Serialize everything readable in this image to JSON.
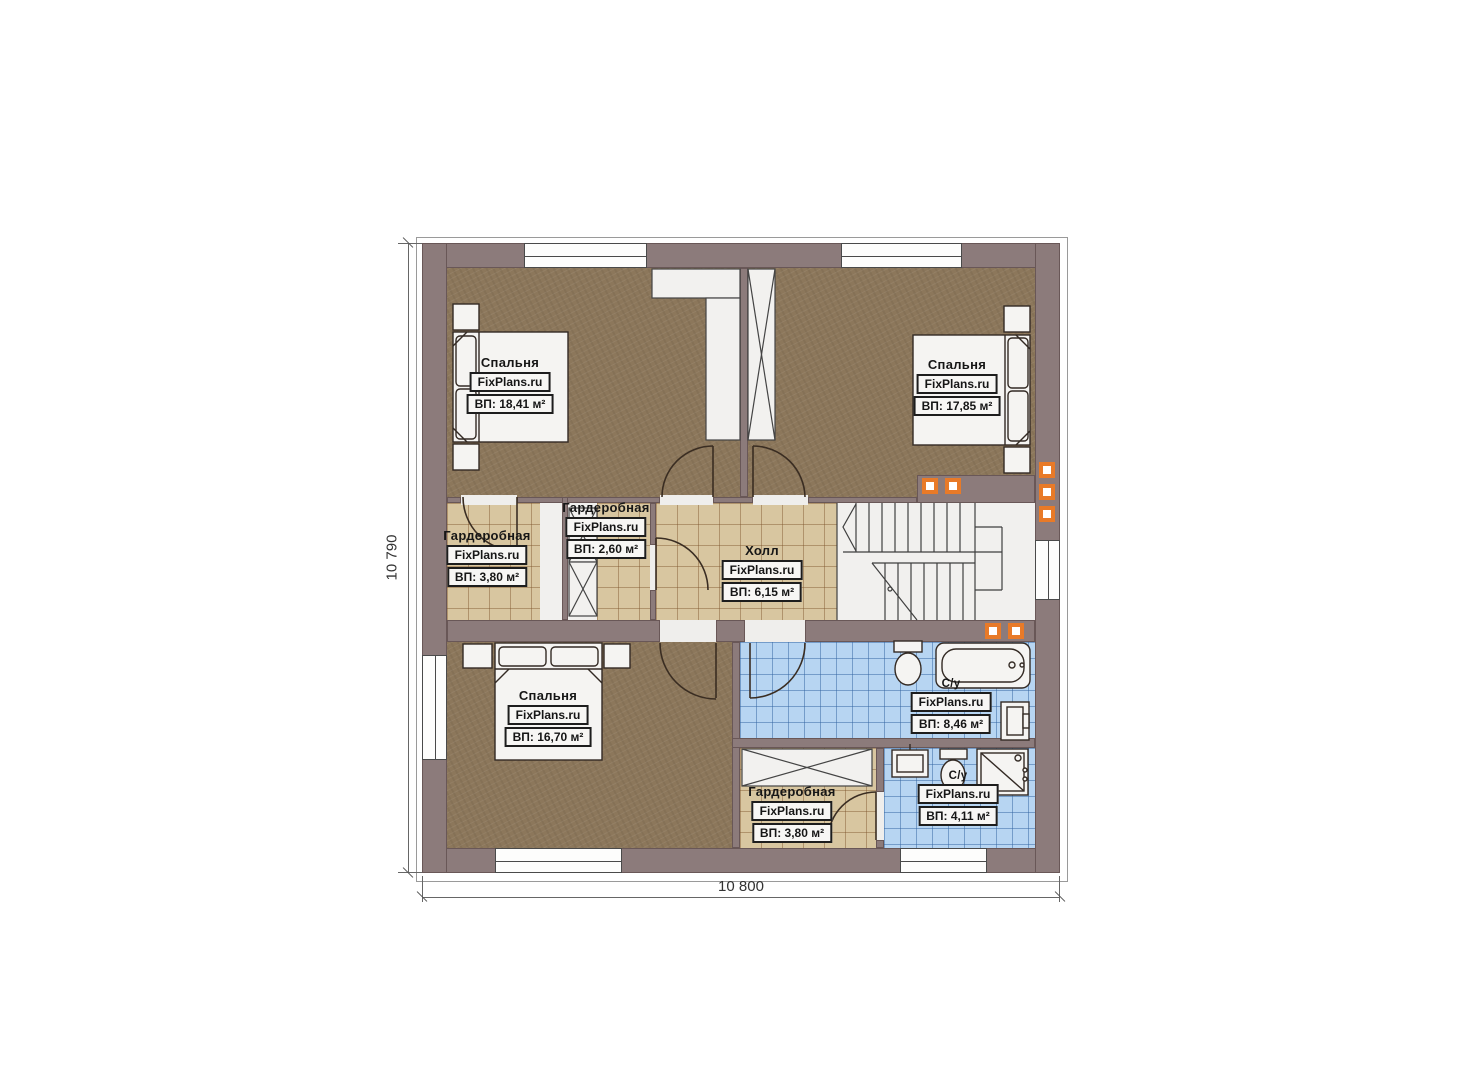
{
  "brand": "FixPlans.ru",
  "dimensions": {
    "width": "10 800",
    "height": "10 790"
  },
  "rooms": [
    {
      "name": "Спальня",
      "brand": "FixPlans.ru",
      "area": "ВП: 18,41 м²"
    },
    {
      "name": "Спальня",
      "brand": "FixPlans.ru",
      "area": "ВП: 17,85 м²"
    },
    {
      "name": "Гардеробная",
      "brand": "FixPlans.ru",
      "area": "ВП: 3,80 м²"
    },
    {
      "name": "Гардеробная",
      "brand": "FixPlans.ru",
      "area": "ВП: 2,60 м²"
    },
    {
      "name": "Холл",
      "brand": "FixPlans.ru",
      "area": "ВП: 6,15 м²"
    },
    {
      "name": "Спальня",
      "brand": "FixPlans.ru",
      "area": "ВП: 16,70 м²"
    },
    {
      "name": "С/у",
      "brand": "FixPlans.ru",
      "area": "ВП: 8,46 м²"
    },
    {
      "name": "Гардеробная",
      "brand": "FixPlans.ru",
      "area": "ВП: 3,80 м²"
    },
    {
      "name": "С/у",
      "brand": "FixPlans.ru",
      "area": "ВП: 4,11 м²"
    }
  ],
  "colors": {
    "wall": "#8c7b7b",
    "carpet": "#8c775b",
    "tile_beige": "#d8c6a0",
    "tile_blue": "#b7d5f2",
    "accent_orange": "#e87a28"
  }
}
